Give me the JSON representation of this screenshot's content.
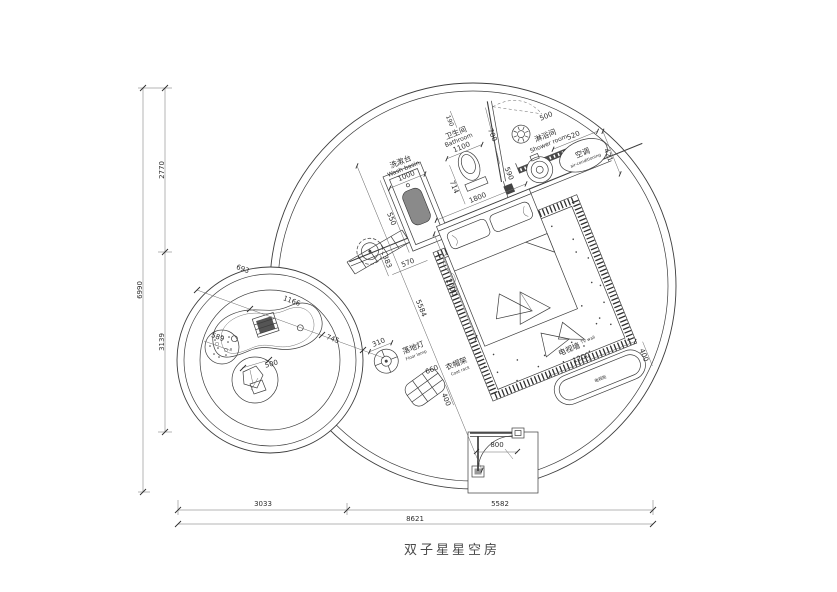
{
  "title": "双子星星空房",
  "rooms": {
    "washbasin": {
      "cn": "洗漱台",
      "en": "Wash basin",
      "dim": "1000"
    },
    "bathroom": {
      "cn": "卫生间",
      "en": "Bathroom",
      "dim": "1100"
    },
    "shower": {
      "cn": "淋浴间",
      "en": "Shower room"
    },
    "ac": {
      "cn": "空调",
      "en": "air-conditioning"
    },
    "floor_lamp": {
      "cn": "落地灯",
      "en": "Floor lamp"
    },
    "coat_rack": {
      "cn": "衣帽架",
      "en": "Coat rack"
    },
    "tv_wall": {
      "cn": "电视墙",
      "en": "TV wall"
    },
    "tv_cabinet": {
      "cn": "电视柜"
    }
  },
  "dims": {
    "d190": "190",
    "d700": "700",
    "d500_door": "500",
    "d590": "590",
    "d550": "550",
    "d714": "714",
    "d1800": "1800",
    "d383": "383",
    "d570": "570",
    "d2000": "2000",
    "d5584": "5584",
    "d310": "310",
    "d660": "660",
    "d400_coat": "400",
    "d1200": "1200",
    "d400_tv": "400",
    "d520": "520",
    "d421": "421",
    "d800": "800",
    "d693": "693",
    "d1166": "1166",
    "d745": "745",
    "d589": "589",
    "d500_rock": "500",
    "left_total": "6990",
    "left_top": "2770",
    "left_bottom": "3139",
    "bottom_left": "3033",
    "bottom_right": "5582",
    "bottom_total": "8621"
  }
}
